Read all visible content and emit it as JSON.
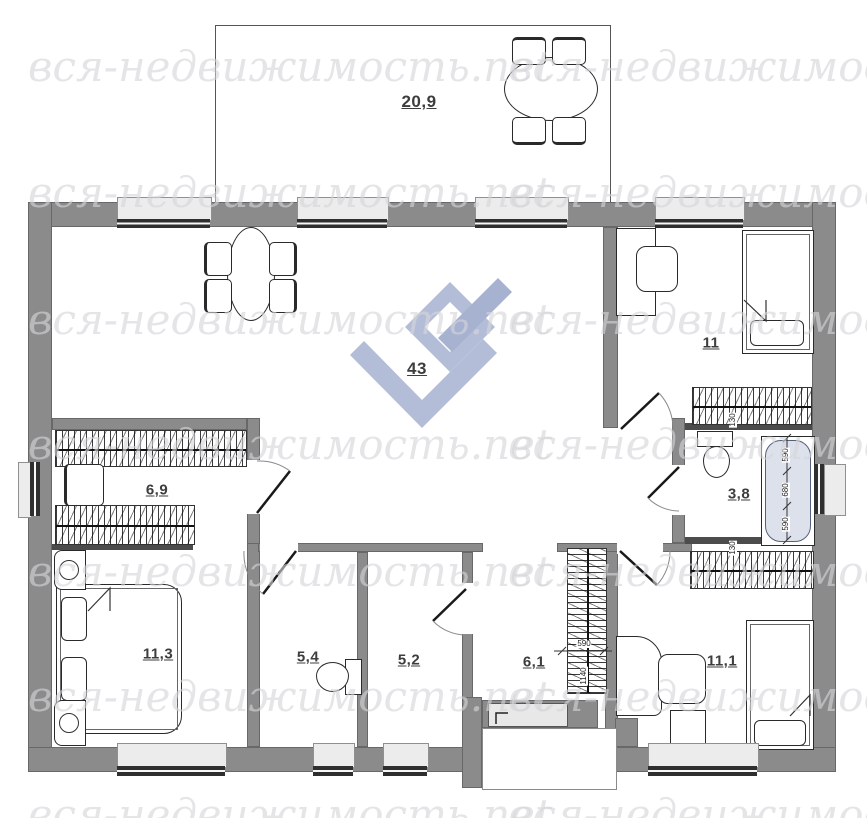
{
  "watermark": {
    "text": "вся-недвижимость.net"
  },
  "rooms": [
    {
      "name": "terrace",
      "area": "20,9"
    },
    {
      "name": "living-room",
      "area": "43"
    },
    {
      "name": "bedroom-top-right",
      "area": "11"
    },
    {
      "name": "dressing-room",
      "area": "6,9"
    },
    {
      "name": "bathroom",
      "area": "3,8"
    },
    {
      "name": "bedroom-left",
      "area": "11,3"
    },
    {
      "name": "wc",
      "area": "5,4"
    },
    {
      "name": "pantry",
      "area": "5,2"
    },
    {
      "name": "hallway",
      "area": "6,1"
    },
    {
      "name": "bedroom-bottom-right",
      "area": "11,1"
    }
  ],
  "dimensions": {
    "bathtub": [
      "590",
      "680",
      "590"
    ],
    "wall_thickness": [
      "130",
      "130"
    ],
    "hall_wardrobe": [
      "590",
      "1140"
    ]
  },
  "colors": {
    "wall": "#8b8b8b",
    "wall_dark": "#4c4c4c",
    "logo_light": "#b4bdd8",
    "logo_mid": "#a7b2d1",
    "tub": "#dce1ec",
    "sill": "#ececec",
    "frame": "#2f2f2f",
    "watermark": "#d6d6da"
  }
}
